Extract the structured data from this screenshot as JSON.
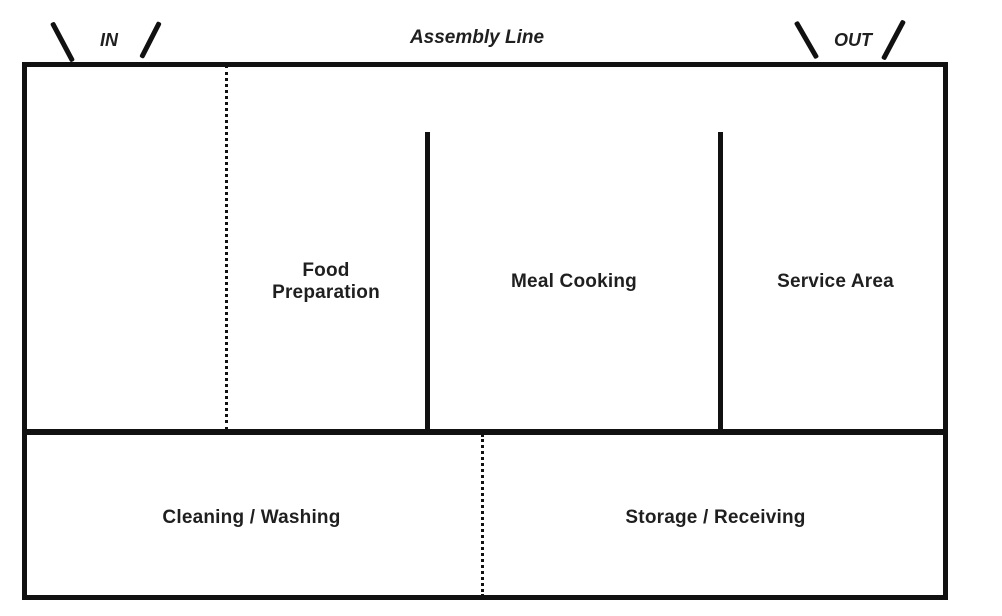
{
  "diagram": {
    "title": "Assembly Line",
    "doors": {
      "in": "IN",
      "out": "OUT"
    },
    "zones": {
      "food_preparation": "Food Preparation",
      "meal_cooking": "Meal Cooking",
      "service_area": "Service Area",
      "cleaning_washing": "Cleaning / Washing",
      "storage_receiving": "Storage / Receiving"
    },
    "colors": {
      "wall_line": "#111111",
      "text": "#1f1f1f",
      "background": "#ffffff"
    }
  }
}
